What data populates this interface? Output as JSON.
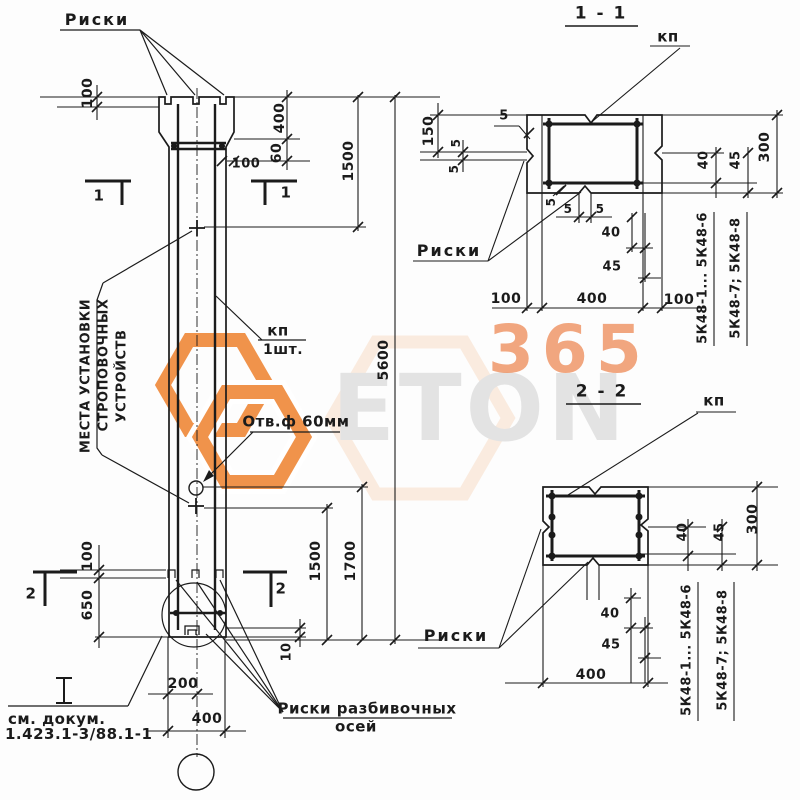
{
  "watermark": {
    "digits": "365",
    "word": "ETON"
  },
  "dims": {
    "v5": "5",
    "v10": "10",
    "v40": "40",
    "v45": "45",
    "v60": "60",
    "v100": "100",
    "v150": "150",
    "v200": "200",
    "v300": "300",
    "v400": "400",
    "v650": "650",
    "v1500": "1500",
    "v1700": "1700",
    "v5600": "5600"
  },
  "elev": {
    "riski": "Риски",
    "cut1": "1",
    "cut2": "2",
    "kp": "кп",
    "kp_qty": "1шт.",
    "otv": "Отв.ф 60мм",
    "note1": "МЕСТА УСТАНОВКИ",
    "note2": "СТРОПОВОЧНЫХ",
    "note3": "УСТРОЙСТВ",
    "doc1": "см. докум.",
    "doc2": "1.423.1-3/88.1-1",
    "axes1": "Риски разбивочных",
    "axes2": "осей"
  },
  "s11": {
    "title": "1 - 1",
    "kp": "кп",
    "riski": "Риски",
    "mark_a": "5К48-1... 5К48-6",
    "mark_b": "5К48-7; 5К48-8"
  },
  "s22": {
    "title": "2 - 2",
    "kp": "кп",
    "riski": "Риски",
    "mark_a": "5К48-1... 5К48-6",
    "mark_b": "5К48-7; 5К48-8"
  }
}
